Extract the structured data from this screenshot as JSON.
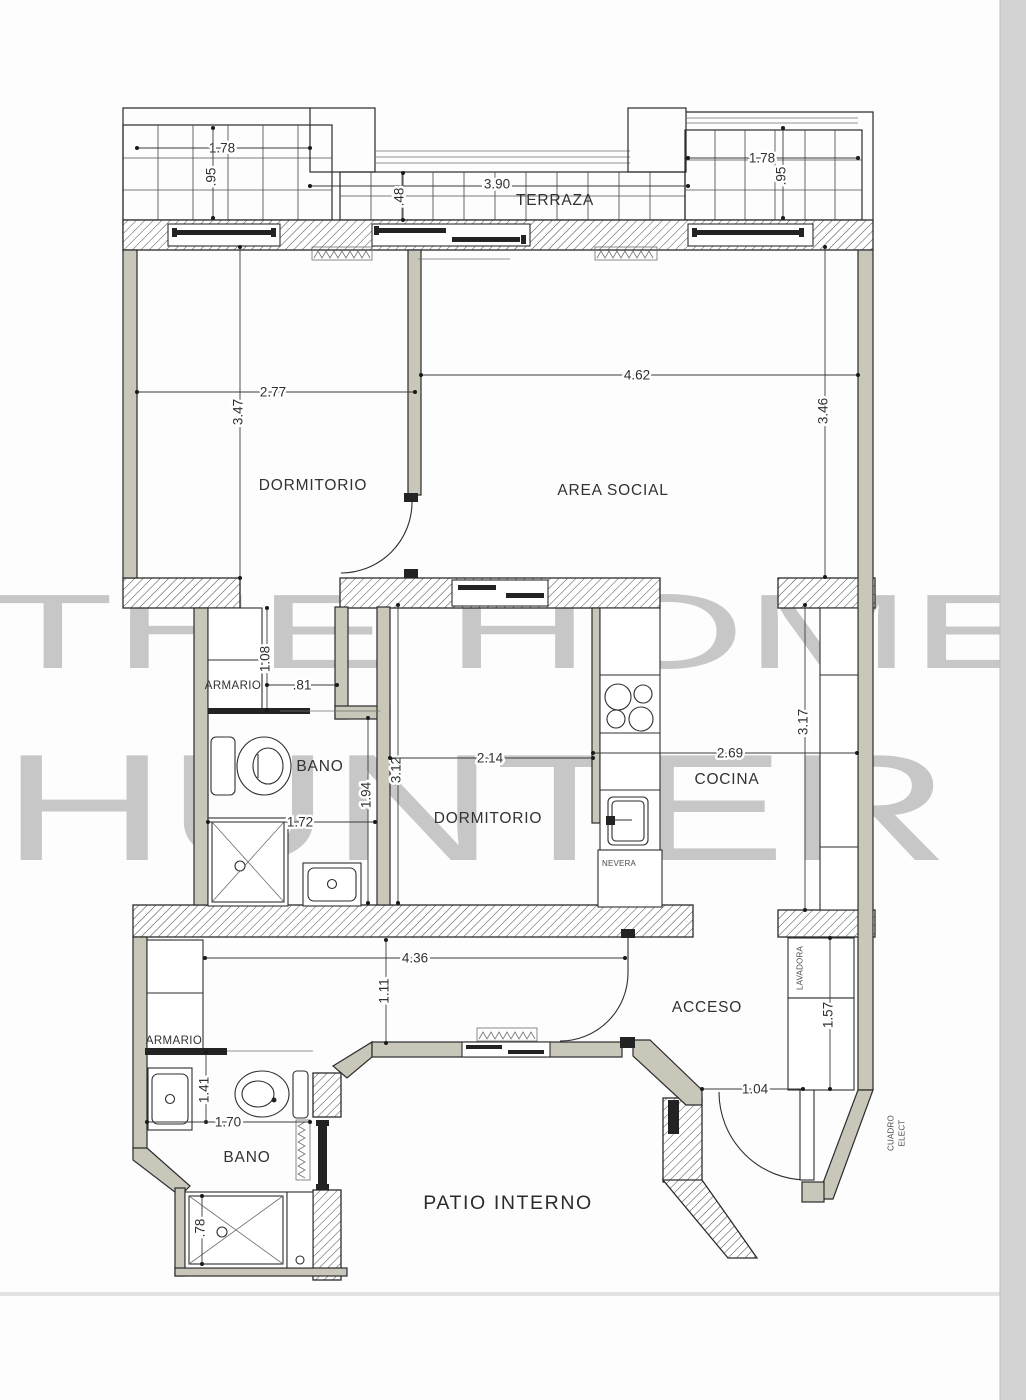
{
  "watermark": {
    "line1": "THE HOME",
    "line2": "HUNTER"
  },
  "labels": {
    "terraza": "TERRAZA",
    "dormitorio_1": "DORMITORIO",
    "area_social": "AREA SOCIAL",
    "armario_1": "ARMARIO",
    "bano_1": "BANO",
    "dormitorio_2": "DORMITORIO",
    "cocina": "COCINA",
    "nevera": "NEVERA",
    "acceso": "ACCESO",
    "lavadora": "LAVADORA",
    "armario_2": "ARMARIO",
    "bano_2": "BANO",
    "patio_interno": "PATIO INTERNO",
    "cuadro_line1": "CUADRO",
    "cuadro_line2": "ELECT"
  },
  "dimensions": {
    "terrace_left_width": "1.78",
    "terrace_left_depth": ".95",
    "terrace_center_width": "3.90",
    "terrace_center_depth": ".48",
    "terrace_right_width": "1.78",
    "terrace_right_depth": ".95",
    "dormitorio1_width": "2.77",
    "dormitorio1_depth": "3.47",
    "area_social_width": "4.62",
    "area_social_depth": "3.46",
    "armario1_depth": "1.08",
    "armario1_width": ".81",
    "bano1_width": "1.72",
    "bano1_depth": "1.94",
    "dormitorio2_width": "2.14",
    "dormitorio2_depth": "3.12",
    "cocina_width": "2.69",
    "cocina_depth": "3.17",
    "pasillo_width": "4.36",
    "pasillo_depth": "1.11",
    "lavadero_depth": "1.57",
    "entrada_width": "1.04",
    "bano2_depth": "1.41",
    "bano2_width": "1.70",
    "ducha2_width": ".78"
  },
  "colors": {
    "wall_fill": "#c8c7b9",
    "watermark": "#c7c7c7",
    "line": "#2b2b2b",
    "page_edge": "#d2d2d2"
  }
}
